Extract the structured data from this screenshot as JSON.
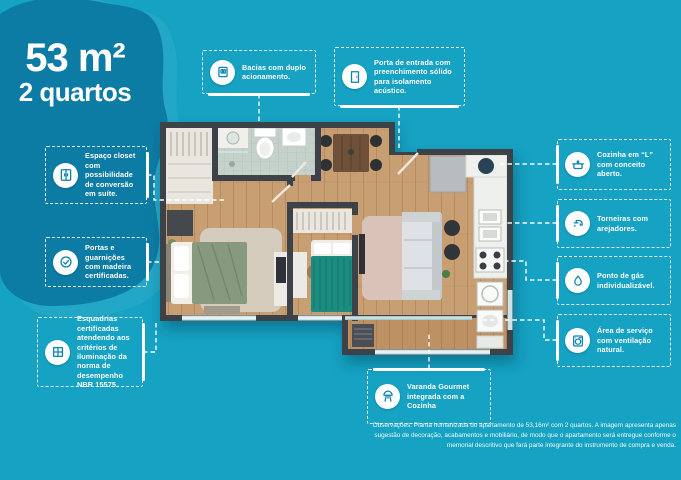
{
  "page": {
    "colors": {
      "background": "#15a2c3",
      "blob": "#0d7ca4",
      "wall": "#3e434a",
      "wood_floor": "#c89e73",
      "accent_teal_bed": "#1f8b80"
    }
  },
  "title": {
    "area": "53 m²",
    "units": "2 quartos"
  },
  "callouts": [
    {
      "id": "bacias",
      "icon": "dual-flush-icon",
      "label": "Bacias com duplo acionamento."
    },
    {
      "id": "porta-entrada",
      "icon": "door-icon",
      "label": "Porta de entrada com preenchimento sólido para isolamento acústico."
    },
    {
      "id": "espaco-closet",
      "icon": "closet-icon",
      "label": "Espaço closet com possibilidade de conversão em suíte."
    },
    {
      "id": "portas-guarnicoes",
      "icon": "certified-check-icon",
      "label": "Portas e guarnições com madeira certificadas."
    },
    {
      "id": "esquadrias",
      "icon": "window-icon",
      "label": "Esquadrias certificadas atendendo aos critérios de iluminação da norma de desempenho NBR 15575."
    },
    {
      "id": "cozinha-em-l",
      "icon": "cooking-pot-icon",
      "label": "Cozinha em “L” com conceito aberto."
    },
    {
      "id": "torneiras",
      "icon": "faucet-icon",
      "label": "Torneiras com arejadores."
    },
    {
      "id": "ponto-gas",
      "icon": "gas-flame-icon",
      "label": "Ponto de gás individualizável."
    },
    {
      "id": "area-servico",
      "icon": "washing-machine-icon",
      "label": "Área de serviço com ventilação natural."
    },
    {
      "id": "varanda-gourmet",
      "icon": "grill-icon",
      "label": "Varanda Gourmet integrada com a Cozinha"
    }
  ],
  "disclaimer": "Observações: Planta humanizada do apartamento de 53,16m² com 2 quartos. A imagem apresenta apenas sugestão de decoração, acabamentos e mobiliário, de modo que o apartamento será entregue conforme o memorial descritivo que fará parte integrante do instrumento de compra e venda."
}
